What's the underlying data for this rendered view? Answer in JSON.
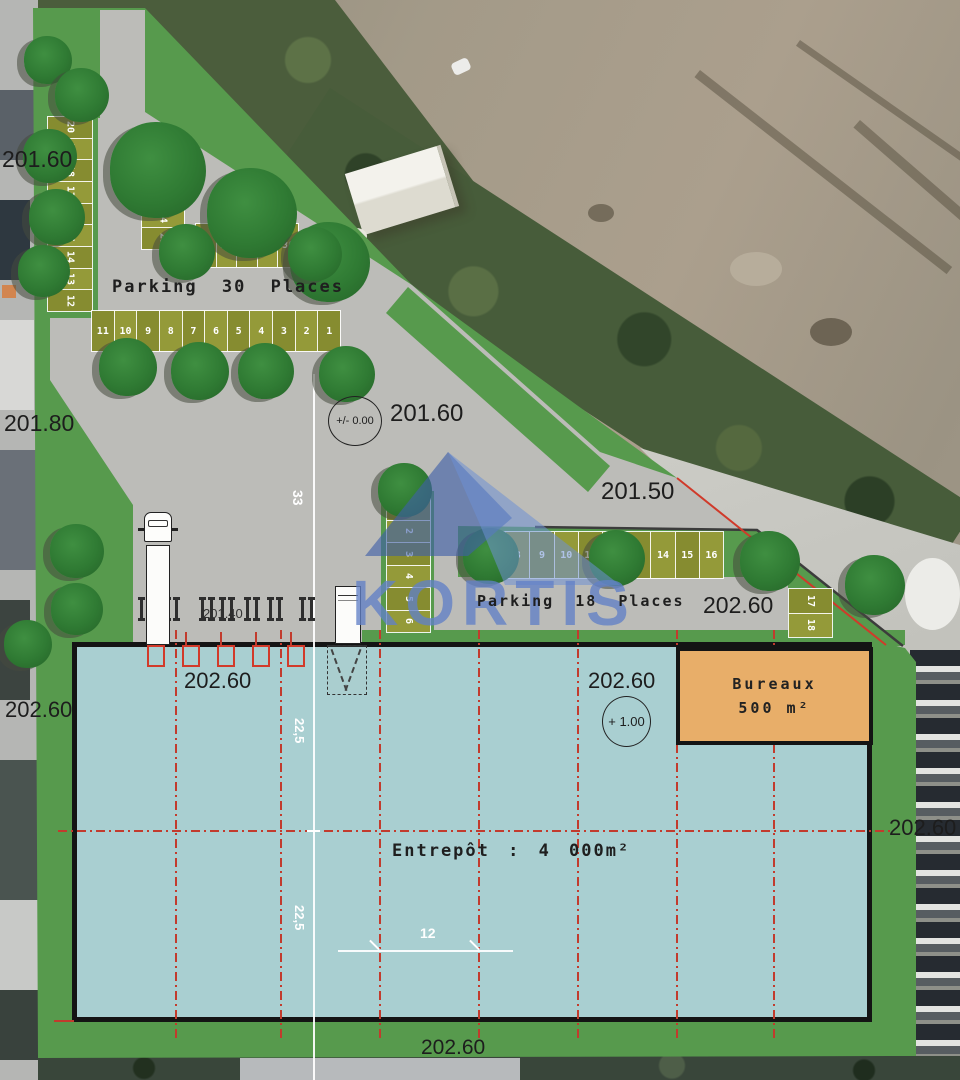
{
  "site": {
    "parking30": {
      "label": "Parking 30 Places",
      "column_left": [
        "20",
        "19",
        "18",
        "17",
        "16",
        "15",
        "14",
        "13",
        "12"
      ],
      "column_mid": [
        "21",
        "22",
        "23",
        "24",
        "25"
      ],
      "row_top": [
        "26",
        "27",
        "28",
        "29",
        "30"
      ],
      "row_bottom": [
        "11",
        "10",
        "9",
        "8",
        "7",
        "6",
        "5",
        "4",
        "3",
        "2",
        "1"
      ]
    },
    "parking18": {
      "label": "Parking 18 Places",
      "column": [
        "1",
        "2",
        "3",
        "4",
        "5",
        "6"
      ],
      "row": [
        "7",
        "8",
        "9",
        "10",
        "11",
        "12",
        "13",
        "14",
        "15",
        "16"
      ],
      "column_right": [
        "17",
        "18"
      ]
    },
    "warehouse": {
      "label": "Entrepôt : 4 000m²",
      "level": "202.60",
      "level_marker": "+ 1.00"
    },
    "offices": {
      "name": "Bureaux",
      "area": "500 m²"
    },
    "docks": {
      "level": "202.60",
      "sub_level": "201.40"
    }
  },
  "levels": {
    "top_left": "201.60",
    "left_mid": "201.80",
    "left_low": "202.60",
    "yard": "201.60",
    "yard_marker": "+/- 0.00",
    "road": "201.50",
    "parking18": "202.60",
    "right": "202.60",
    "bottom": "202.60"
  },
  "dimensions": {
    "yard_height": "33",
    "bay_top": "22,5",
    "bay_bottom": "22,5",
    "bay_width": "12"
  },
  "watermark": {
    "text": "KORTIS"
  },
  "colors": {
    "grass": "#579a4d",
    "asphalt": "#bcbcb8",
    "stall": "#8d9334",
    "warehouse": "#a9cfd1",
    "offices": "#e8ae69",
    "grid_red": "#c23b2d",
    "watermark_blue": "#5b7fc4"
  }
}
